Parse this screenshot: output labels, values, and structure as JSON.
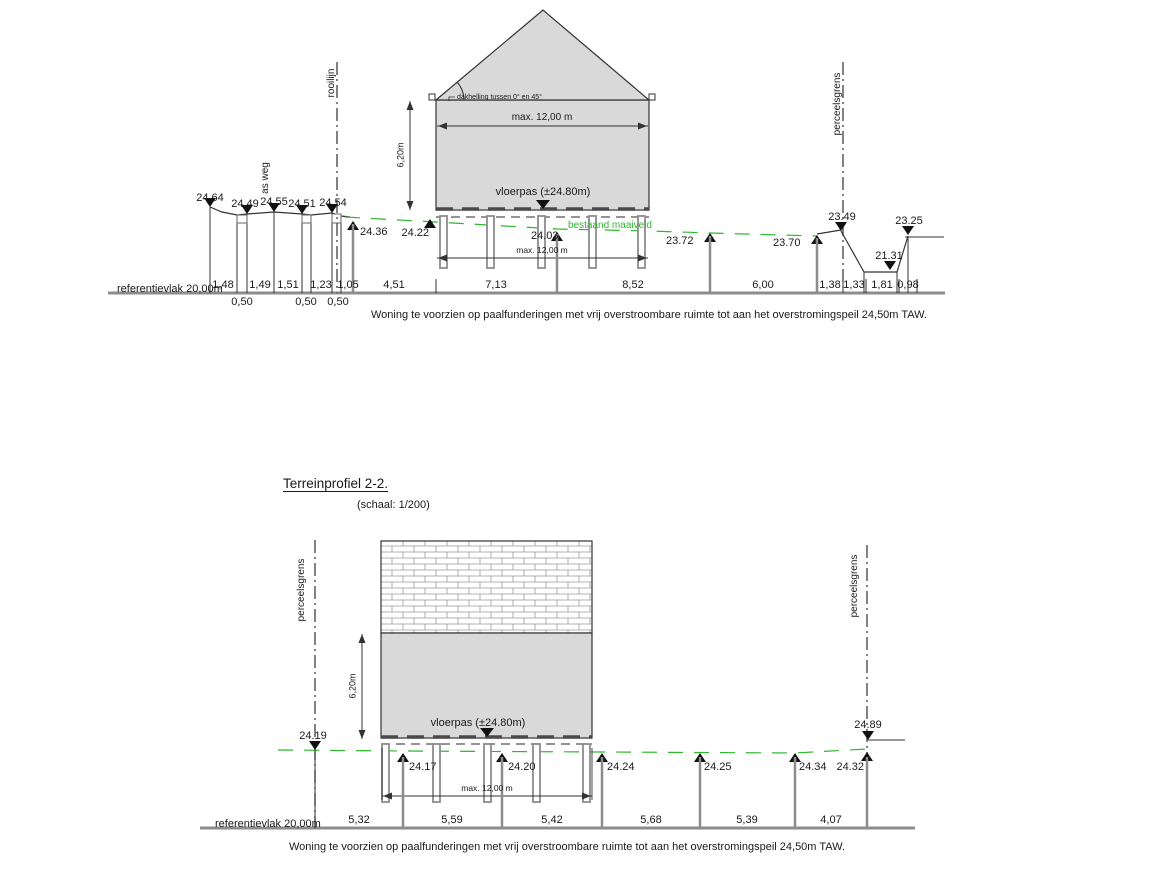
{
  "drawing": {
    "type": "terrain profile cross-sections",
    "colors": {
      "building_fill": "#d9d9d9",
      "maaiveld_green": "#2eb82e",
      "line": "#333333",
      "pile_gray": "#8c8c8c"
    }
  },
  "p1": {
    "referentievlak": "referentievlak 20,00m",
    "as_weg": "as weg",
    "rooilijn": "rooilijn",
    "perceelsgrens": "perceelsgrens",
    "dakhelling": "dakhelling tussen 0° en 45°",
    "max_breedte_boven": "max. 12,00 m",
    "max_breedte_onder": "max. 12,00 m",
    "hoogte": "6,20m",
    "vloerpas": "vloerpas (±24.80m)",
    "maaiveld": "bestaand maaiveld",
    "caption": "Woning te voorzien op paalfunderingen met vrij overstroombare ruimte tot aan het overstromingspeil 24,50m TAW.",
    "pointsDown": [
      "24.64",
      "24.49",
      "24.55",
      "24.51",
      "24.54"
    ],
    "pointsUp": [
      "24.36",
      "24.22",
      "24.03",
      "23.72",
      "23.70"
    ],
    "pointsRight": [
      "23.49",
      "21.31",
      "23.25"
    ],
    "dims": [
      "1,48",
      "1,49",
      "1,51",
      "1,23",
      "1,05",
      "4,51",
      "7,13",
      "8,52",
      "6,00",
      "1,38",
      "1,33",
      "1,81",
      "0,98"
    ],
    "dimsBelow": [
      "0,50",
      "0,50",
      "0,50"
    ]
  },
  "p2": {
    "title": "Terreinprofiel 2-2.",
    "schaal": "(schaal: 1/200)",
    "referentievlak": "referentievlak 20,00m",
    "perceelsgrens_links": "perceelsgrens",
    "perceelsgrens_rechts": "perceelsgrens",
    "hoogte": "6,20m",
    "vloerpas": "vloerpas (±24.80m)",
    "max_breedte": "max. 12,00 m",
    "left_marker": "24.19",
    "high_marker": "24.89",
    "pointsUp": [
      "24.17",
      "24.20",
      "24.24",
      "24.25",
      "24.34",
      "24.32"
    ],
    "dims": [
      "5,32",
      "5,59",
      "5,42",
      "5,68",
      "5,39",
      "4,07"
    ],
    "caption": "Woning te voorzien op paalfunderingen met vrij overstroombare ruimte tot aan het overstromingspeil 24,50m TAW."
  }
}
